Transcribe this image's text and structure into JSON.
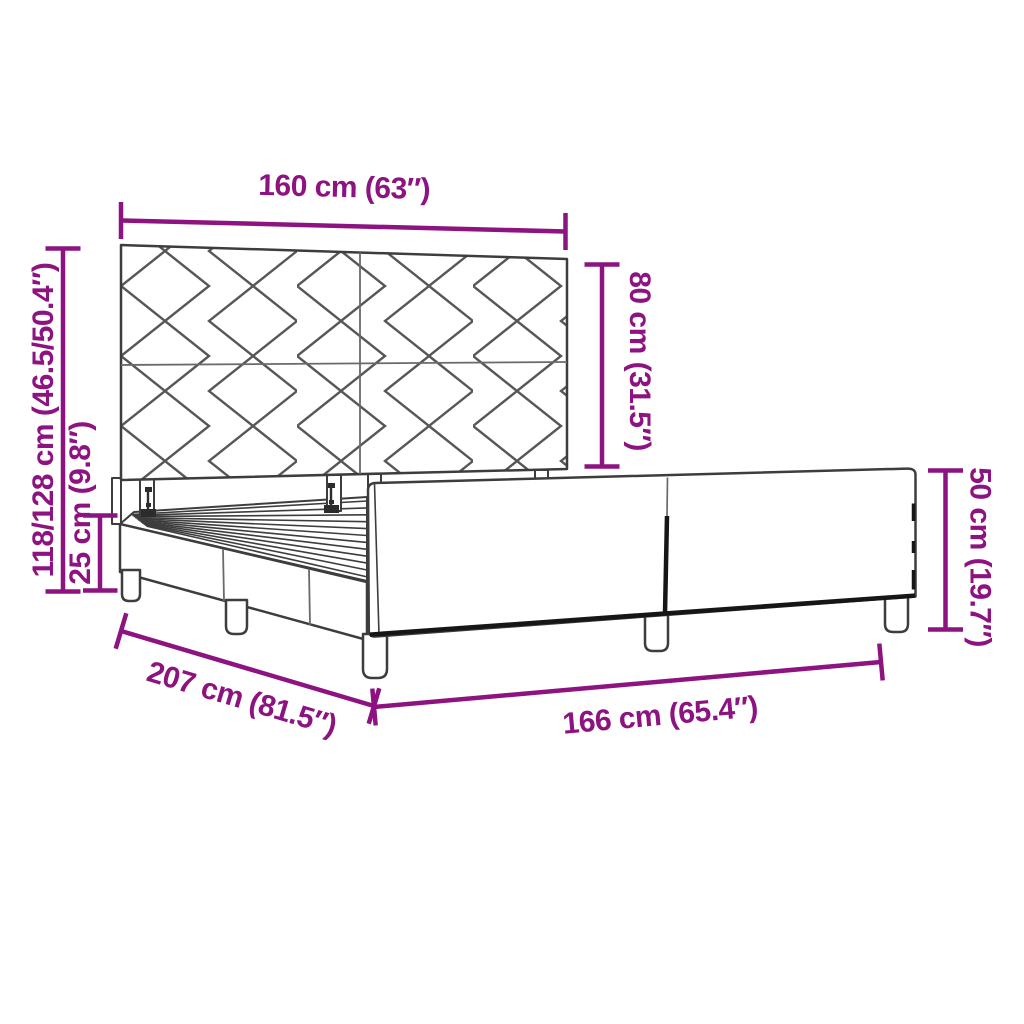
{
  "colors": {
    "accent": "#8c1380",
    "line_art": "#3d3d3d",
    "dark_edge": "#161616"
  },
  "diagram": {
    "subject": "bed-frame-with-diamond-pattern-headboard",
    "dimensions": {
      "headboard_width": {
        "label": "160 cm (63″)",
        "cm": "160",
        "inches": "63"
      },
      "headboard_panel_height": {
        "label": "80 cm (31.5″)",
        "cm": "80",
        "inches": "31.5"
      },
      "overall_height": {
        "label": "118/128 cm (46.5/50.4″)",
        "cm": "118/128",
        "inches": "46.5/50.4"
      },
      "base_height": {
        "label": "25 cm (9.8″)",
        "cm": "25",
        "inches": "9.8"
      },
      "footboard_height": {
        "label": "50 cm (19.7″)",
        "cm": "50",
        "inches": "19.7"
      },
      "frame_length": {
        "label": "207 cm (81.5″)",
        "cm": "207",
        "inches": "81.5"
      },
      "frame_width": {
        "label": "166 cm (65.4″)",
        "cm": "166",
        "inches": "65.4"
      }
    }
  }
}
